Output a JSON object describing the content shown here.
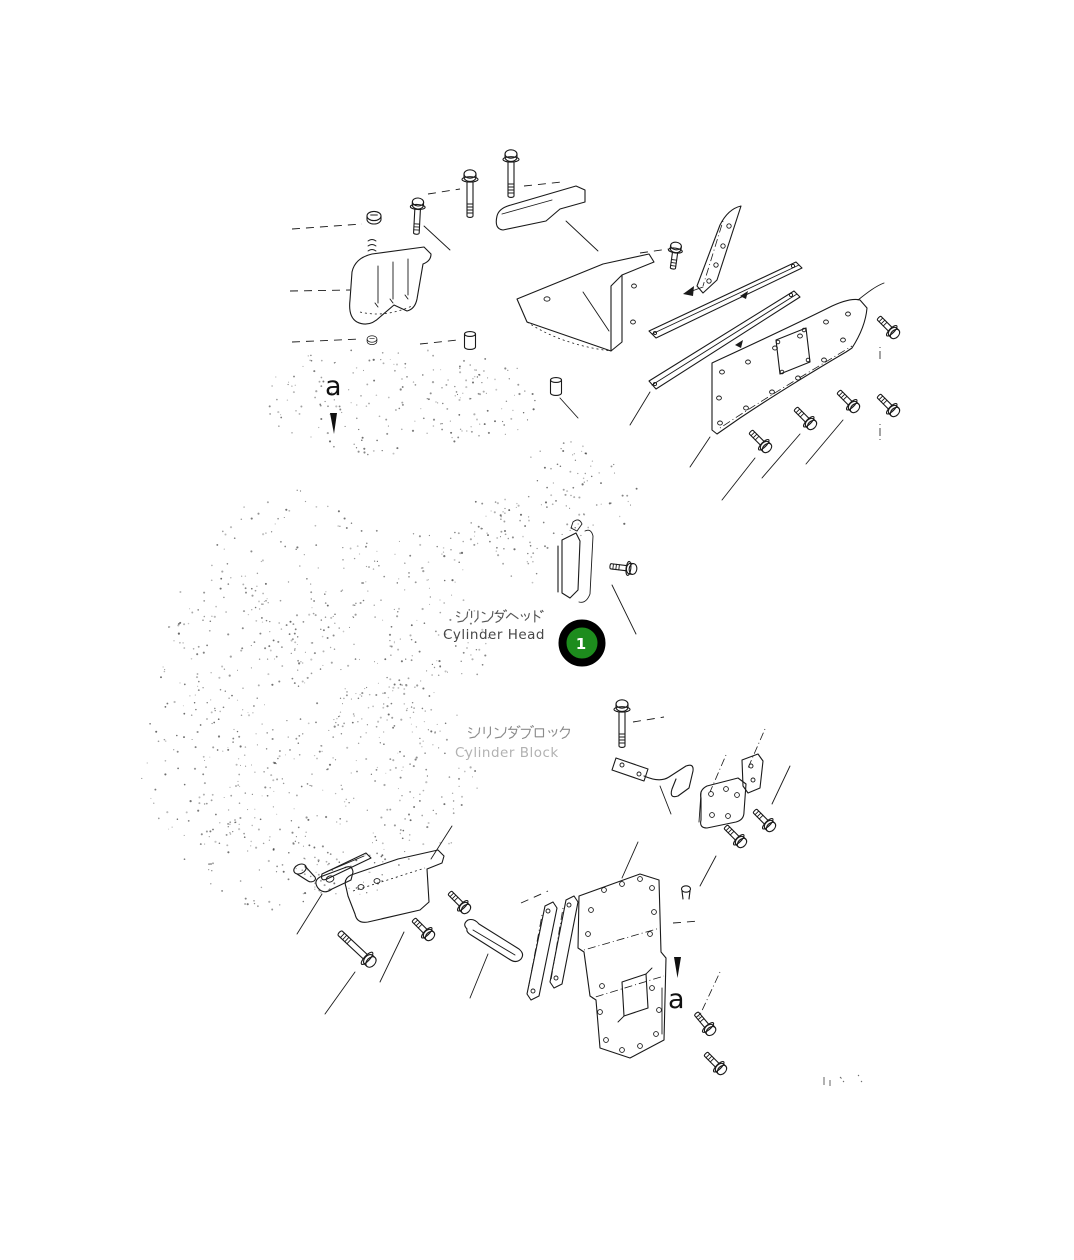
{
  "diagram": {
    "background_color": "#ffffff",
    "line_color": "#1a1a1a",
    "faint_dot_color": "#404040",
    "view_markers": {
      "top": "a",
      "bottom": "a"
    },
    "labels": {
      "cylinder_head": {
        "jp": "シリンダヘッド",
        "en": "Cylinder Head"
      },
      "cylinder_block": {
        "jp": "シリンダブロック",
        "en": "Cylinder Block"
      }
    },
    "callout": {
      "number": "1",
      "fill_color": "#1d8c1d",
      "ring_color": "#000000",
      "text_color": "#ffffff"
    }
  }
}
